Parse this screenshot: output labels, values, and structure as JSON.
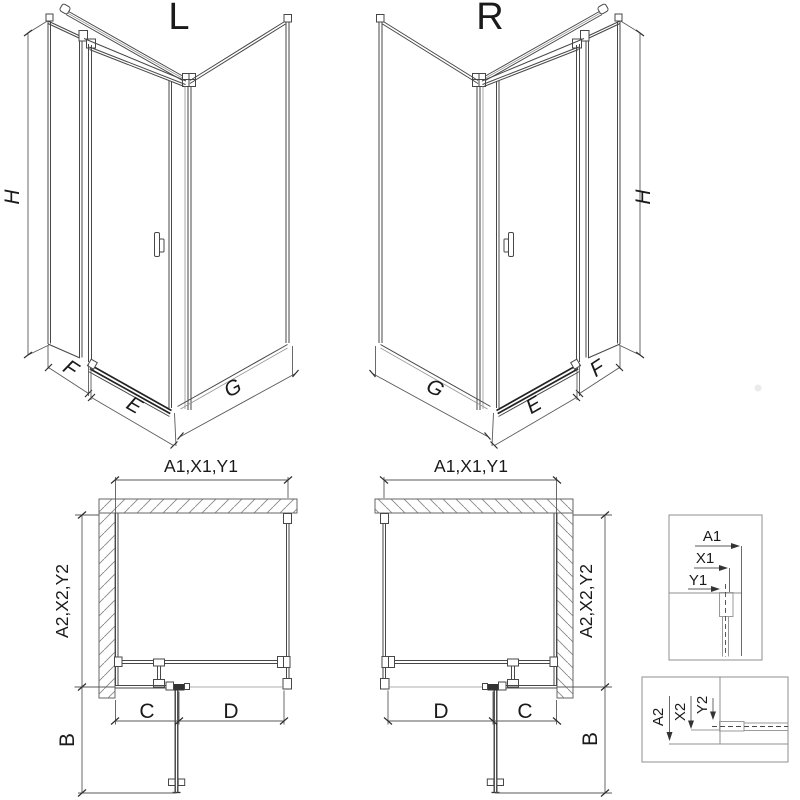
{
  "drawing": {
    "iso_left": {
      "title": "L",
      "dim_h": "H",
      "dim_f": "F",
      "dim_e": "E",
      "dim_g": "G"
    },
    "iso_right": {
      "title": "R",
      "dim_h": "H",
      "dim_f": "F",
      "dim_e": "E",
      "dim_g": "G"
    },
    "plan_left": {
      "dim_top": "A1,X1,Y1",
      "dim_side": "A2,X2,Y2",
      "dim_b": "B",
      "dim_c": "C",
      "dim_d": "D"
    },
    "plan_right": {
      "dim_top": "A1,X1,Y1",
      "dim_side": "A2,X2,Y2",
      "dim_b": "B",
      "dim_d": "D",
      "dim_c": "C"
    },
    "detail_top": {
      "a": "A1",
      "x": "X1",
      "y": "Y1"
    },
    "detail_bottom": {
      "a": "A2",
      "x": "X2",
      "y": "Y2"
    },
    "colors": {
      "line": "#474747",
      "dark": "#232323",
      "dimension": "#5a5a5a",
      "wall_outline": "#666666",
      "detail_box": "#8f8f8f",
      "text": "#1a1a1a",
      "background": "#ffffff"
    }
  }
}
